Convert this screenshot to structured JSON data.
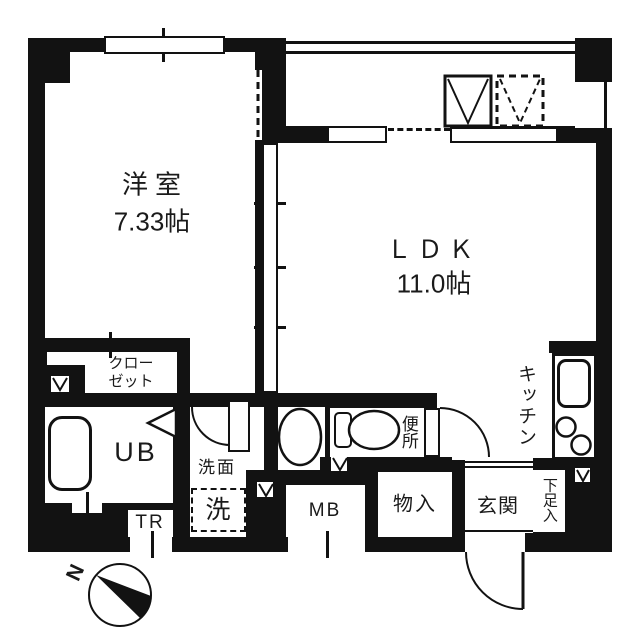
{
  "plan_title": "apartment-floorplan",
  "rooms": {
    "western": {
      "name": "洋室",
      "size": "7.33帖"
    },
    "ldk": {
      "name": "ＬＤＫ",
      "size": "11.0帖"
    },
    "closet": {
      "line1": "クロー",
      "line2": "ゼット"
    },
    "unit_bath": {
      "name": "UB"
    },
    "washroom": {
      "name": "洗面"
    },
    "toilet": {
      "name": "便所"
    },
    "entrance": {
      "name": "玄関"
    },
    "storage": {
      "name": "物入"
    },
    "shoe_cabinet": {
      "name": "下足入"
    },
    "kitchen": {
      "name": "キッチン"
    }
  },
  "fixtures": {
    "washing_machine": "洗",
    "meter_box": "MB",
    "trunk_room": "TR"
  },
  "compass": {
    "north_label": "N"
  },
  "colors": {
    "wall": "#121212",
    "background": "#ffffff"
  }
}
